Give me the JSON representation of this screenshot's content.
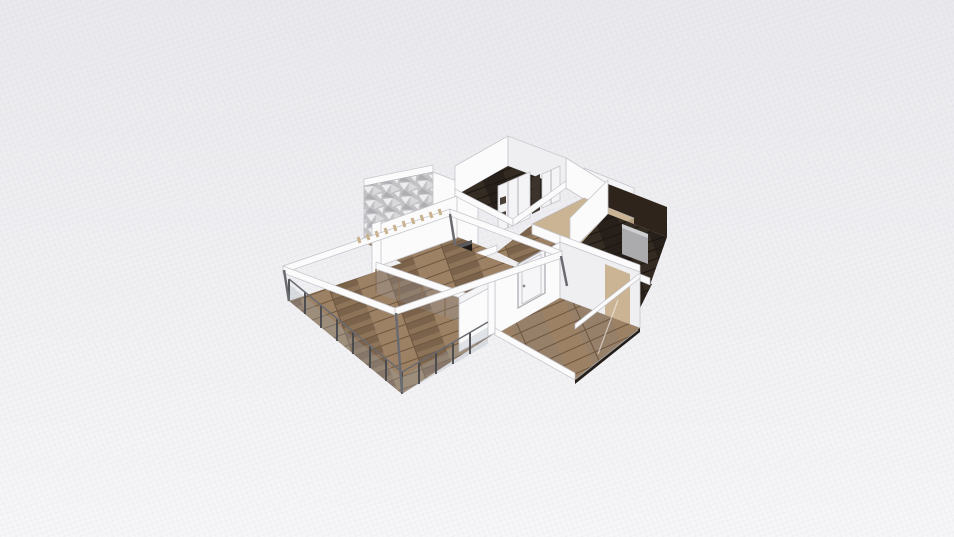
{
  "meta": {
    "view_label": "3D floor plan render",
    "background": "light gray with fine diagonal grid mesh"
  },
  "colors": {
    "bg_top": "#e9e9ed",
    "bg_bottom": "#f6f6f8",
    "wall_white": "#fbfbfc",
    "wall_face": "#f4f4f6",
    "wall_shade": "#e9e9ec",
    "wall_inner": "#efeff2",
    "wood_base": "#8d7357",
    "wood_light": "#9c8164",
    "wood_dark": "#7b624b",
    "wood_seam": "#6d563f",
    "wood2_base": "#97806a",
    "dark_floor": "#27201a",
    "dark_floor_hi": "#342b22",
    "dark_wall": "#2e241c",
    "beige_top": "#cab494",
    "beige_side": "#b29c7c",
    "stone_a": "#d9d9db",
    "stone_b": "#c2c2c5",
    "stone_c": "#ededef",
    "stone_d": "#aeaeb2",
    "glass": "rgba(150,160,172,0.25)",
    "glass_rail": "rgba(160,170,180,0.30)",
    "metal": "#46474b",
    "rail_line": "#6a6b70",
    "frame_brown": "#8a7158",
    "bed_gray": "#ababad",
    "bed_light": "#cfcfd2",
    "unit_dark": "#1d1916",
    "unit_top": "#59595c",
    "door_face": "#f6f6f8",
    "door_stroke": "#a9a9af",
    "knob": "#88888d",
    "slat_tan": "#c9b28e",
    "dark_base": "#241d18",
    "streak": "rgba(255,255,255,0.55)"
  },
  "scene": {
    "elements": [
      {
        "id": "terrace",
        "desc": "wood-plank terrace with glass railing and pergola"
      },
      {
        "id": "living-room",
        "desc": "wood floor, white walls, glass door row"
      },
      {
        "id": "kitchen",
        "desc": "wood floor with dark media unit"
      },
      {
        "id": "stone-accent-wall",
        "desc": "gray mosaic textured wall"
      },
      {
        "id": "bedroom-top",
        "desc": "dark floor, white wardrobe with sliding doors"
      },
      {
        "id": "hallway-platform",
        "desc": "beige raised platform"
      },
      {
        "id": "bedroom-right",
        "desc": "dark floor, gray bed panel, dark back wall"
      },
      {
        "id": "room-bottom-right",
        "desc": "wood floor, white interior door, glass wall"
      }
    ]
  }
}
